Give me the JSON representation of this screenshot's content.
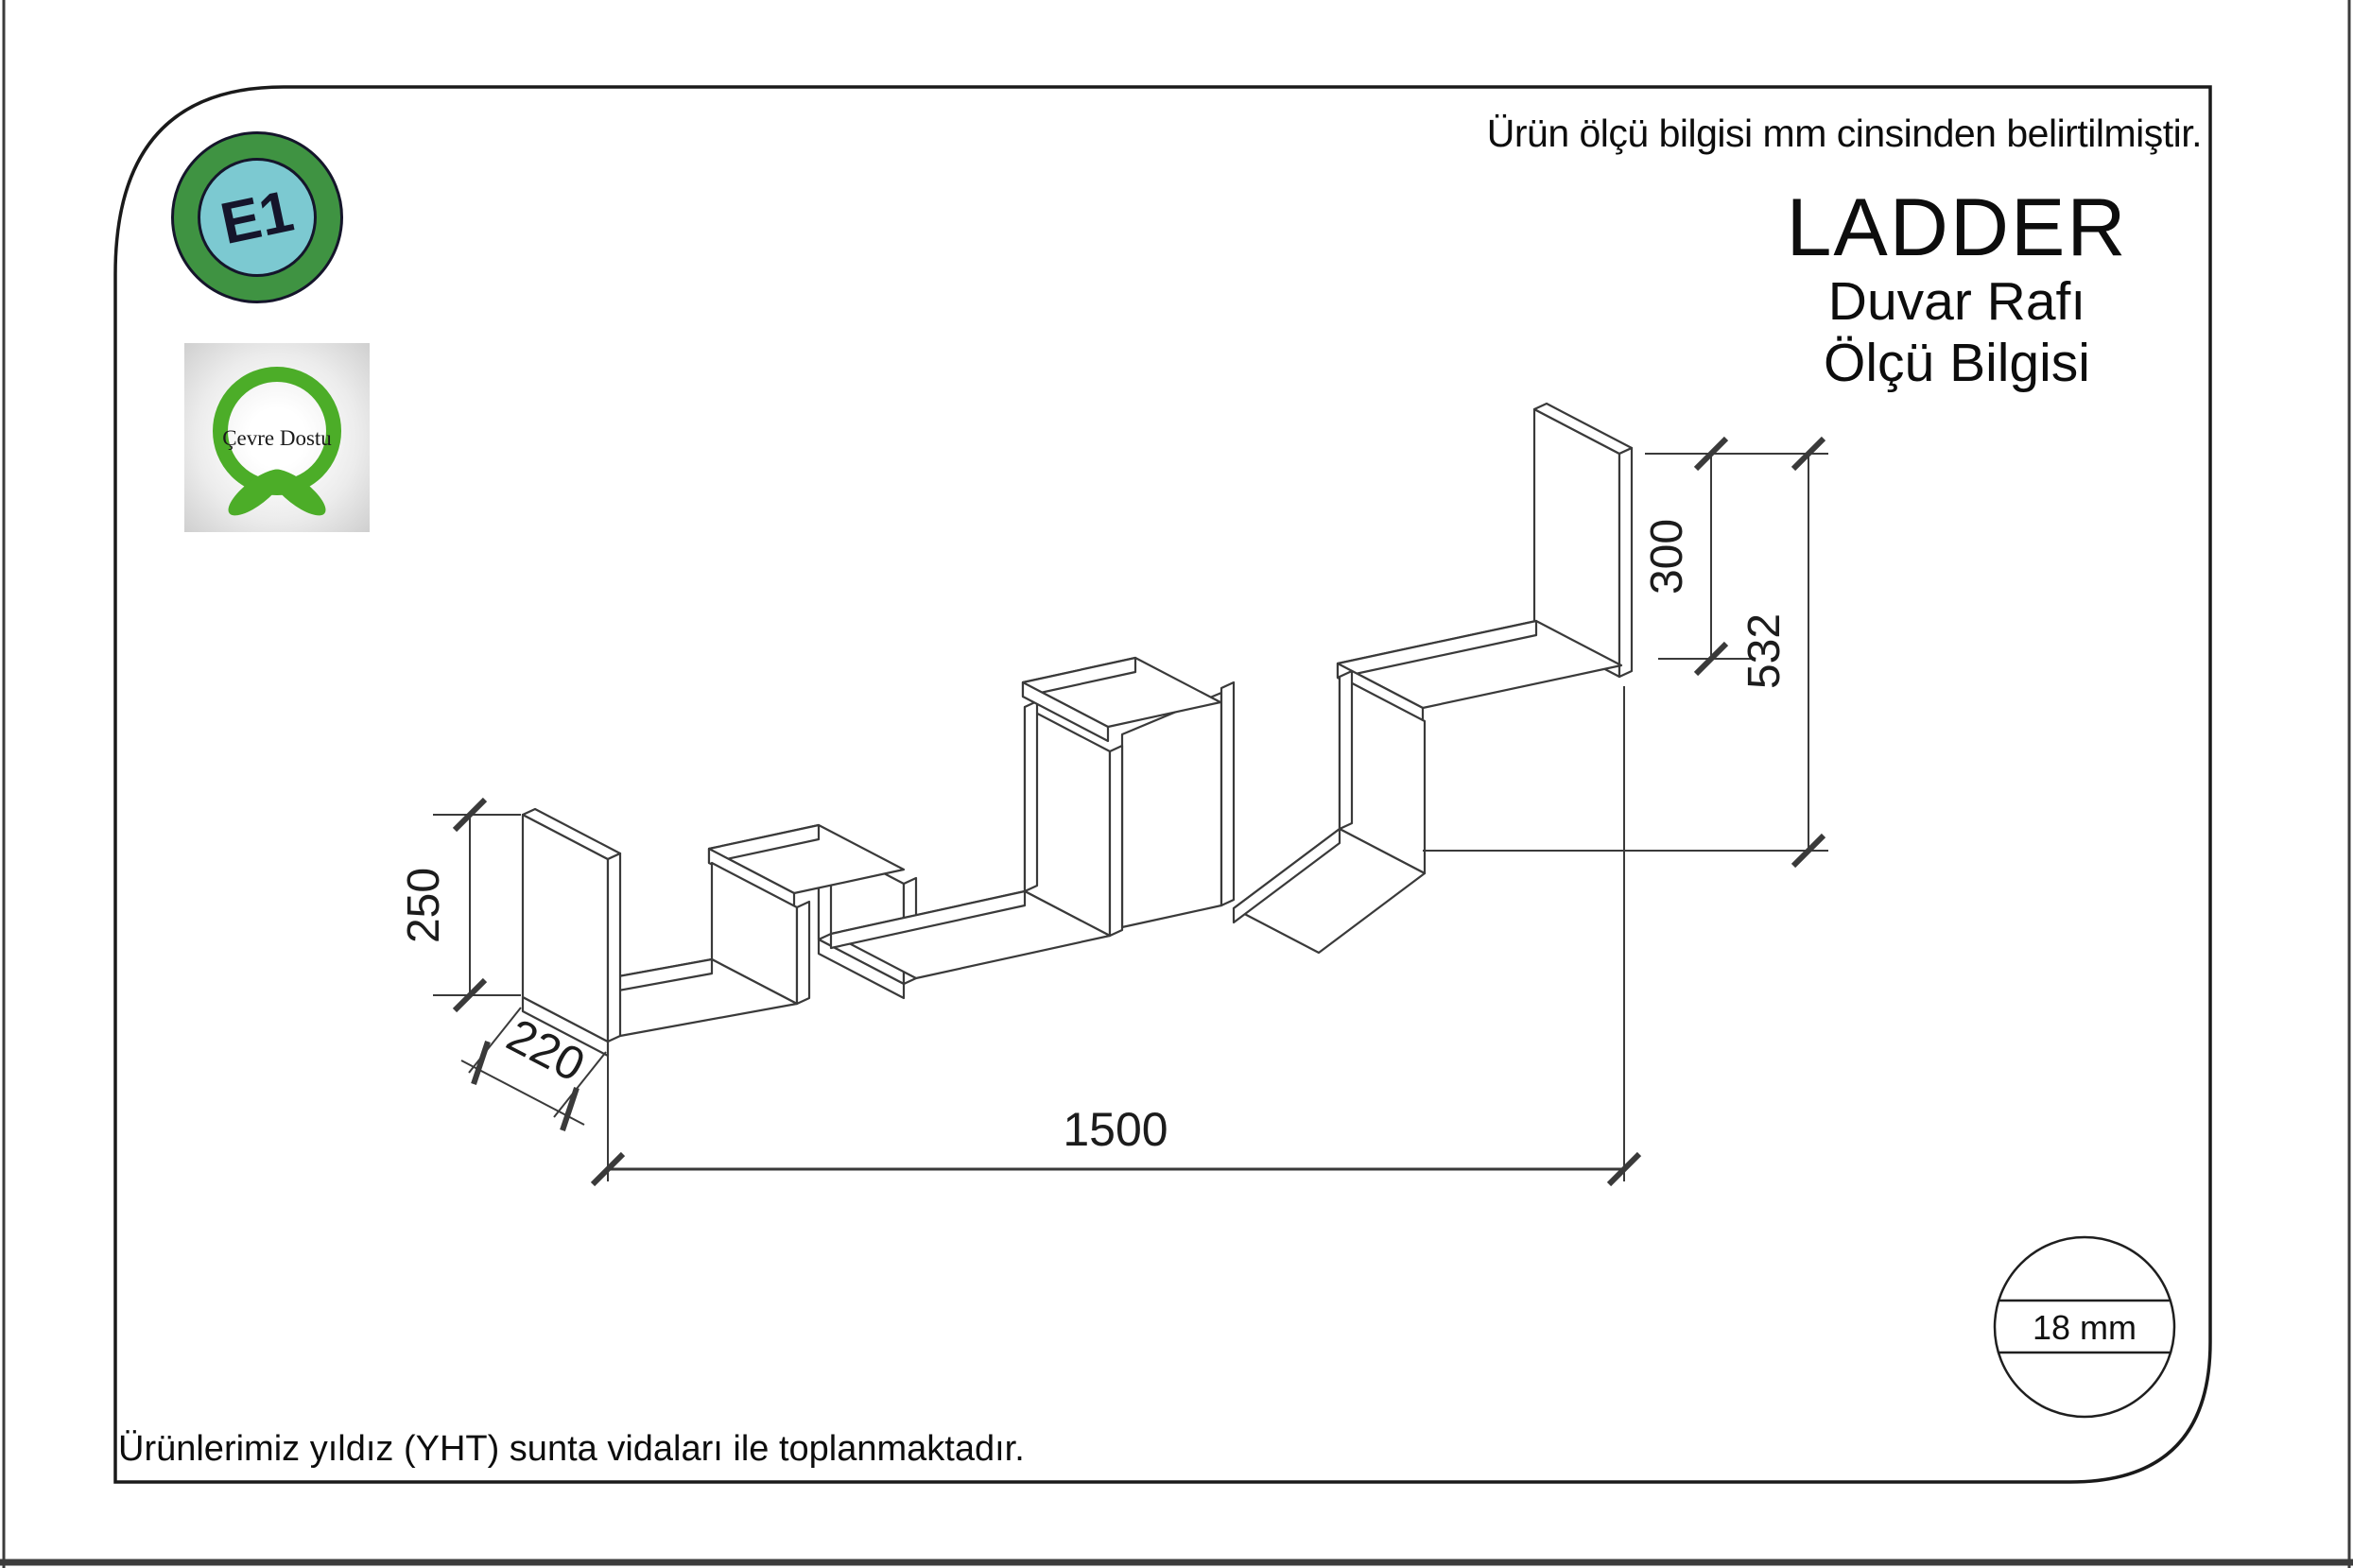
{
  "page": {
    "top_note": "Ürün ölçü bilgisi mm cinsinden belirtilmiştir.",
    "bottom_note": "Ürünlerimiz yıldız (YHT) sunta vidaları ile toplanmaktadır."
  },
  "title": {
    "product_name": "LADDER",
    "product_type": "Duvar Rafı",
    "sheet_type": "Ölçü Bilgisi"
  },
  "badges": {
    "e1_label": "E1",
    "eco_label": "Çevre Dostu"
  },
  "dimensions": {
    "width_mm": "1500",
    "depth_mm": "220",
    "left_panel_height_mm": "250",
    "right_panel_height_mm": "300",
    "total_height_mm": "532",
    "board_thickness": "18 mm"
  },
  "colors": {
    "e1_outer_green": "#3F9342",
    "e1_inner_teal": "#7CC9D1",
    "eco_green": "#4CAD28",
    "drawing_line": "#3a3a3a",
    "frame_line": "#1a1a1a"
  }
}
